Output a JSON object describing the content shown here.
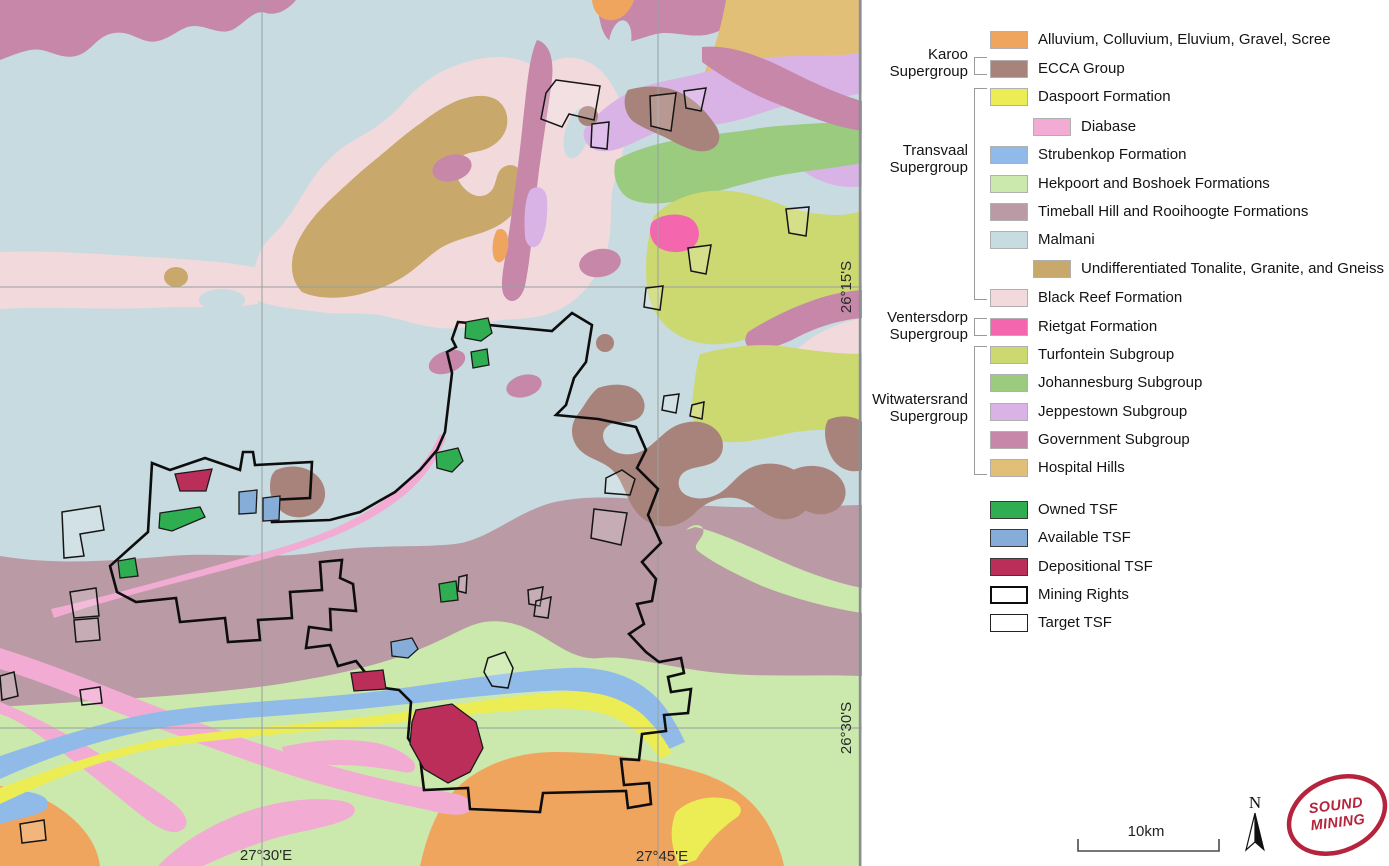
{
  "colors": {
    "alluvium": "#f0a55f",
    "ecca": "#a8837b",
    "daspoort": "#ecec55",
    "diabase": "#f2abd2",
    "strubenkop": "#90bbe8",
    "hekpoort": "#cbe9ad",
    "timeball": "#ba9aa4",
    "malmani": "#c8dbe0",
    "tonalite": "#c9a86c",
    "blackreef": "#f1d9dc",
    "rietgat": "#f467ae",
    "turfontein": "#ccd870",
    "johannesburg": "#9acb7e",
    "jeppestown": "#d9b3e6",
    "government": "#c687a8",
    "hospital": "#e2bf77",
    "owned_tsf": "#2fae51",
    "available_tsf": "#85add8",
    "depositional_tsf": "#bb2e5a",
    "outline": "#111111",
    "grid": "#98a0a2",
    "logo_red": "#b5243c"
  },
  "legend": {
    "groups": [
      {
        "id": "karoo",
        "lines": [
          "Karoo",
          "Supergroup"
        ]
      },
      {
        "id": "transvaal",
        "lines": [
          "Transvaal",
          "Supergroup"
        ]
      },
      {
        "id": "ventersdorp",
        "lines": [
          "Ventersdorp",
          "Supergroup"
        ]
      },
      {
        "id": "witwatersrand",
        "lines": [
          "Witwatersrand",
          "Supergroup"
        ]
      }
    ],
    "items": [
      {
        "id": "alluvium",
        "label": "Alluvium, Colluvium, Eluvium, Gravel, Scree"
      },
      {
        "id": "ecca",
        "label": "ECCA Group"
      },
      {
        "id": "daspoort",
        "label": "Daspoort Formation"
      },
      {
        "id": "diabase",
        "label": "Diabase",
        "indent": true
      },
      {
        "id": "strubenkop",
        "label": "Strubenkop Formation"
      },
      {
        "id": "hekpoort",
        "label": "Hekpoort and Boshoek Formations"
      },
      {
        "id": "timeball",
        "label": "Timeball Hill and Rooihoogte Formations"
      },
      {
        "id": "malmani",
        "label": "Malmani"
      },
      {
        "id": "tonalite",
        "label": "Undifferentiated Tonalite, Granite, and Gneiss",
        "indent": true
      },
      {
        "id": "blackreef",
        "label": "Black Reef Formation"
      },
      {
        "id": "rietgat",
        "label": "Rietgat Formation"
      },
      {
        "id": "turfontein",
        "label": "Turfontein Subgroup"
      },
      {
        "id": "johannesburg",
        "label": "Johannesburg Subgroup"
      },
      {
        "id": "jeppestown",
        "label": "Jeppestown Subgroup"
      },
      {
        "id": "government",
        "label": "Government Subgroup"
      },
      {
        "id": "hospital",
        "label": "Hospital Hills"
      },
      {
        "id": "owned_tsf",
        "label": "Owned TSF"
      },
      {
        "id": "available_tsf",
        "label": "Available TSF"
      },
      {
        "id": "depositional_tsf",
        "label": "Depositional TSF"
      },
      {
        "id": "mining_rights",
        "label": "Mining Rights"
      },
      {
        "id": "target_tsf",
        "label": "Target TSF"
      }
    ]
  },
  "map": {
    "grid_labels": {
      "lat": [
        {
          "text": "26°15'S"
        },
        {
          "text": "26°30'S"
        }
      ],
      "lon": [
        {
          "text": "27°30'E"
        },
        {
          "text": "27°45'E"
        }
      ]
    }
  },
  "scale_bar": {
    "label": "10km"
  },
  "north_arrow": {
    "label": "N"
  },
  "logo": {
    "line1": "SOUND",
    "line2": "MINING"
  }
}
